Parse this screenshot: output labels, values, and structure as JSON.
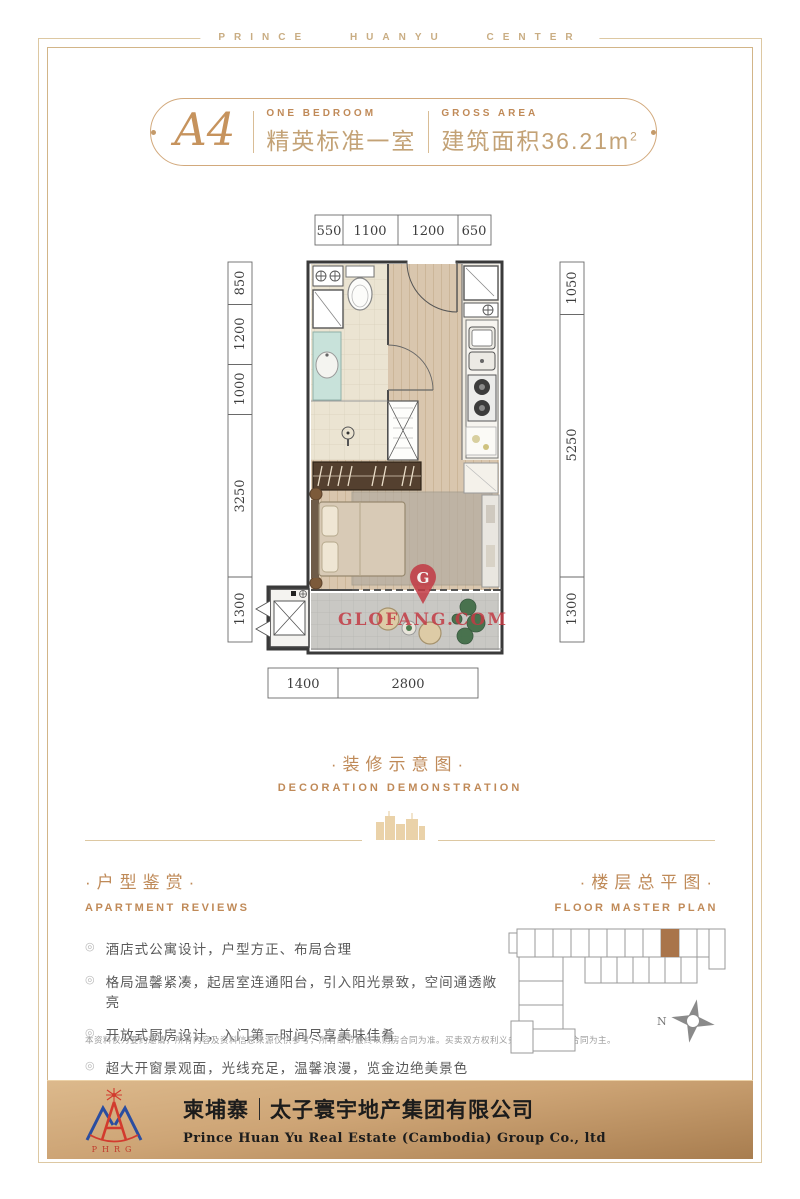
{
  "brand": {
    "header": "PRINCE HUANYU CENTER"
  },
  "badge": {
    "unit": "A4",
    "type_en": "ONE BEDROOM",
    "type_cn": "精英标准一室",
    "area_en": "GROSS AREA",
    "area_cn_label": "建筑面积",
    "area_value": "36.21m",
    "area_exponent": "2"
  },
  "plan": {
    "dims": {
      "top": [
        "550",
        "1100",
        "1200",
        "650"
      ],
      "left": [
        "850",
        "1200",
        "1000",
        "3250",
        "1300"
      ],
      "right": [
        "1050",
        "5250",
        "1300"
      ],
      "bottom": [
        "1400",
        "2800"
      ]
    },
    "watermark": {
      "letter": "G",
      "text": "GLOFANG.COM",
      "color": "#c23a44"
    }
  },
  "decoration": {
    "title_cn": "·装修示意图·",
    "title_en": "DECORATION DEMONSTRATION"
  },
  "reviews": {
    "title_cn": "·户型鉴赏·",
    "title_en": "APARTMENT REVIEWS",
    "bullet_marker": "◎",
    "bullets": [
      "酒店式公寓设计，户型方正、布局合理",
      "格局温馨紧凑，起居室连通阳台，引入阳光景致，空间通透敞亮",
      "开放式厨房设计，入门第一时间尽享美味佳肴",
      "超大开窗景观面，光线充足，温馨浪漫，览金边绝美景色"
    ],
    "disclaimer": "本资料仅为要约邀请，所有内容及资料信息来源仅供参考，所有细节最终以购房合同为准。买卖双方权利义务以双方订立的合同为主。"
  },
  "master_plan": {
    "title_cn": "·楼层总平图·",
    "title_en": "FLOOR MASTER PLAN",
    "compass": "N",
    "highlight_color": "#a9744a"
  },
  "footer": {
    "logo_acronym": "PHRG",
    "region_cn": "柬埔寨",
    "company_cn": "太子寰宇地产集团有限公司",
    "company_en": "Prince Huan Yu Real Estate (Cambodia) Group Co., ltd"
  },
  "colors": {
    "gold": "#bf8a58",
    "gold_line": "#ddc8a2",
    "text_gray": "#5a5a5a"
  }
}
